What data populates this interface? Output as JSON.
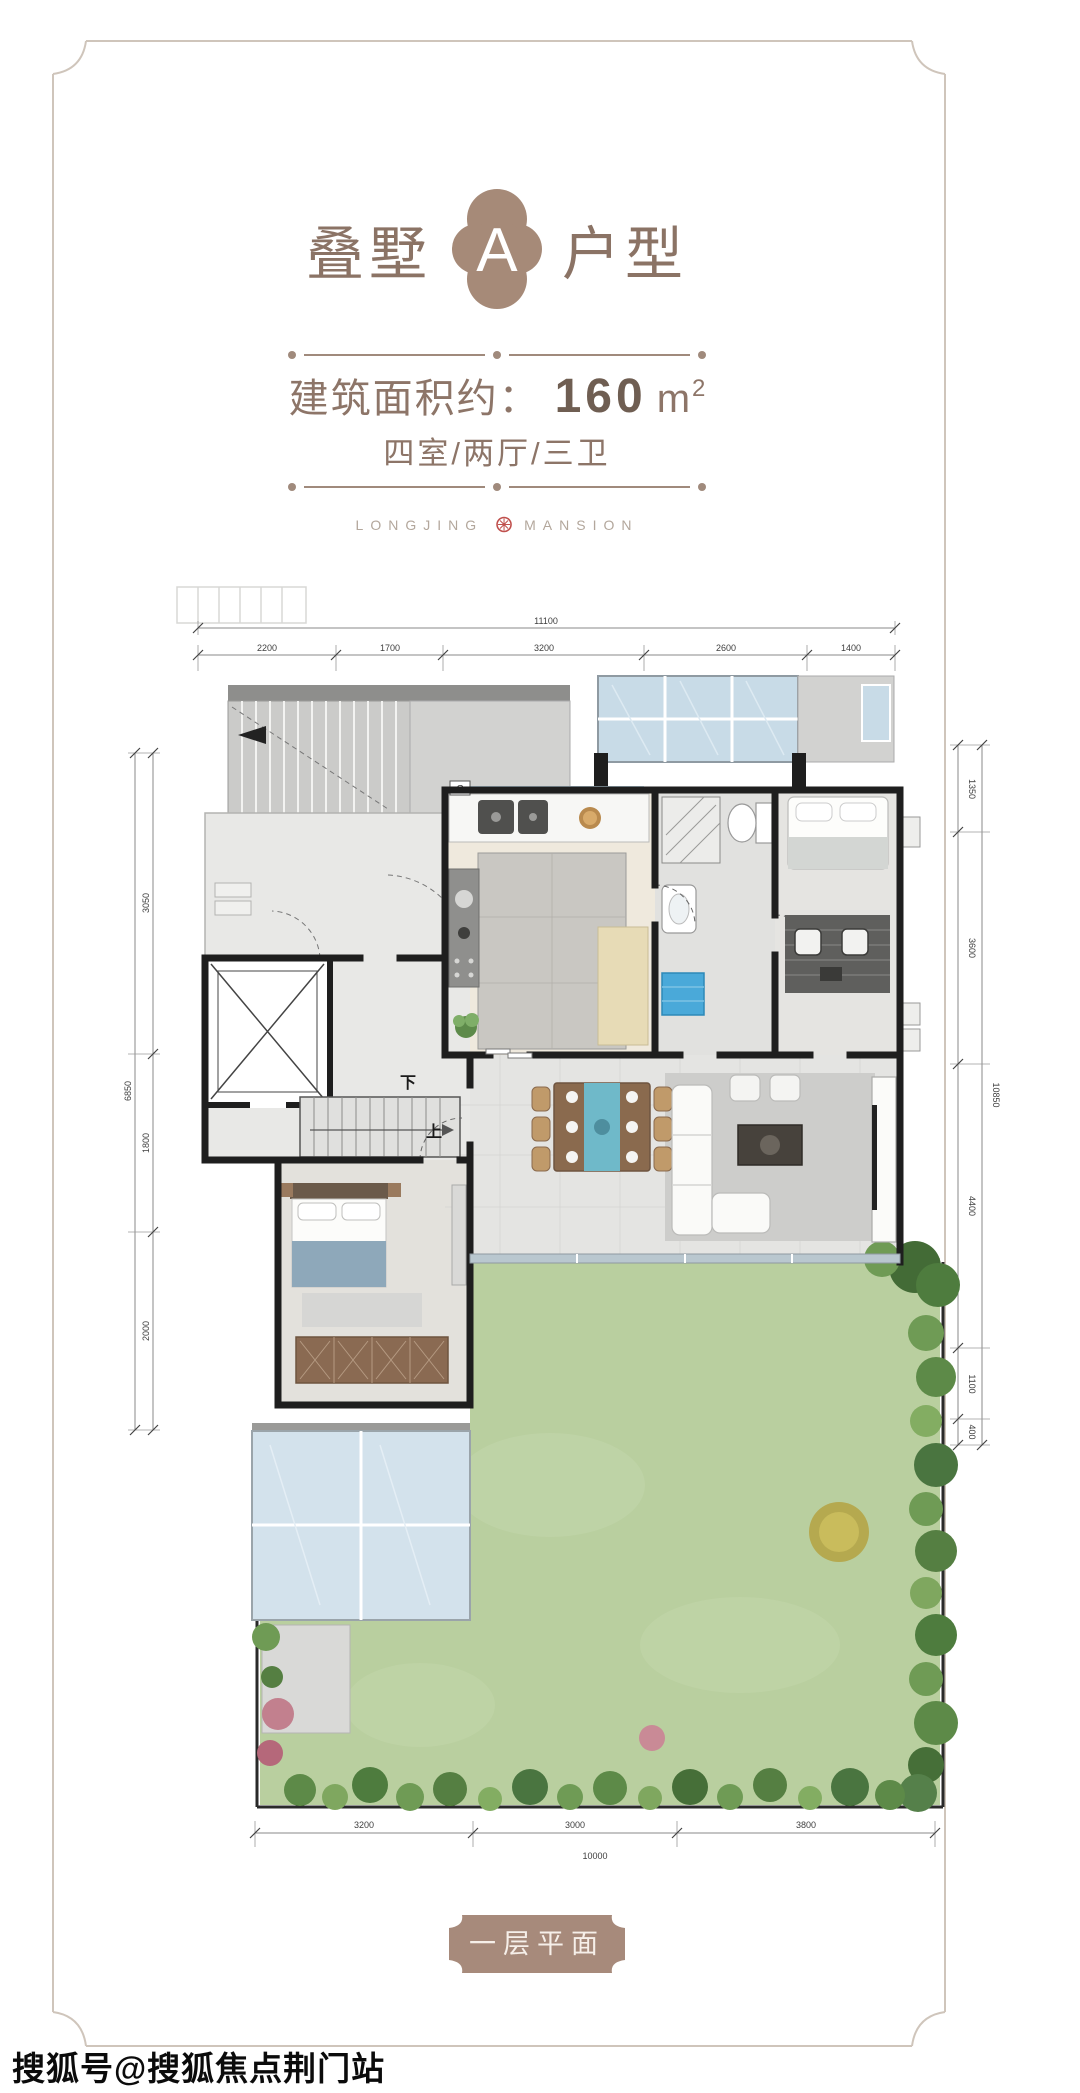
{
  "page": {
    "title": {
      "left": "叠墅",
      "badge": "A",
      "right": "户型"
    },
    "area": {
      "label": "建筑面积约：",
      "value": "160",
      "unit": "m",
      "sup": "2"
    },
    "rooms": "四室/两厅/三卫",
    "brand": {
      "left": "LONGJING",
      "right": "MANSION"
    },
    "plan_label": "一层平面",
    "watermark": "搜狐号@搜狐焦点荆门站"
  },
  "plan": {
    "stair_down": "下",
    "stair_up": "上",
    "wall_mark": "C",
    "dims_top": {
      "total": "11100",
      "segments": [
        "2200",
        "1700",
        "3200",
        "2600",
        "1400"
      ]
    },
    "dims_left": {
      "total": "6850",
      "segments": [
        "3050",
        "1800",
        "2000"
      ]
    },
    "dims_right": {
      "total": "10850",
      "segments": [
        "1350",
        "3600",
        "4400",
        "1100",
        "400"
      ]
    },
    "dims_bottom": {
      "total": "10000",
      "segments": [
        "3200",
        "3000",
        "3800"
      ]
    }
  },
  "colors": {
    "taupe_text": "#8b7365",
    "badge_fill": "#a68a78",
    "plaque_fill": "#a78a7b",
    "divider": "#a08a7c",
    "brand_grey": "#b3a79c",
    "seal_red": "#c0504d",
    "lawn_green": "#b9cf9f",
    "glass_blue": "#c8dbe7",
    "wall_black": "#1e1e1e"
  }
}
